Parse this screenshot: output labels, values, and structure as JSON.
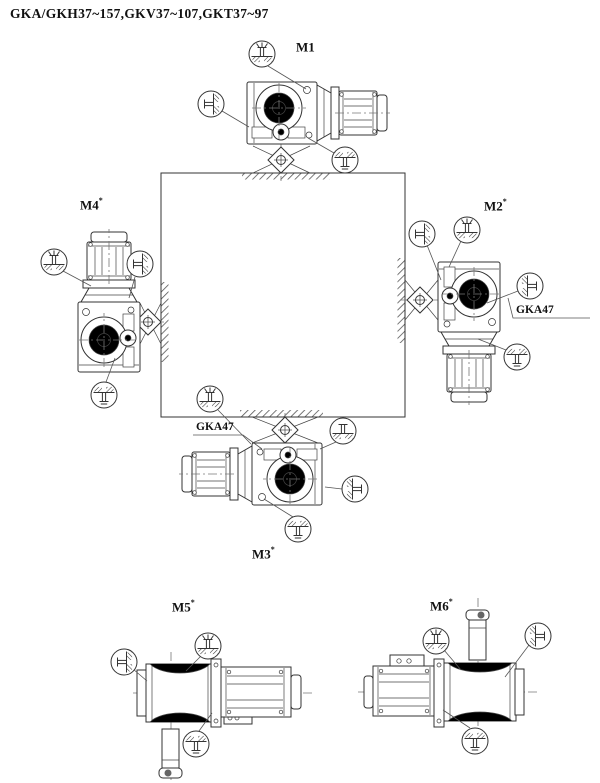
{
  "title": "GKA/GKH37~157,GKV37~107,GKT37~97",
  "positions": [
    {
      "id": "M1",
      "label": "M1",
      "star": ""
    },
    {
      "id": "M2",
      "label": "M2",
      "star": "*"
    },
    {
      "id": "M3",
      "label": "M3",
      "star": "*"
    },
    {
      "id": "M4",
      "label": "M4",
      "star": "*"
    },
    {
      "id": "M5",
      "label": "M5",
      "star": "*"
    },
    {
      "id": "M6",
      "label": "M6",
      "star": "*"
    }
  ],
  "annotations": {
    "gka47_m2": "GKA47",
    "gka47_m3": "GKA47"
  },
  "icons": {
    "breather": "breather-plug-icon",
    "oil_fill": "oil-fill-plug-icon",
    "oil_level": "oil-level-plug-icon",
    "oil_drain": "oil-drain-plug-icon"
  },
  "colors": {
    "line": "#333333",
    "background": "#ffffff",
    "text": "#111111"
  }
}
